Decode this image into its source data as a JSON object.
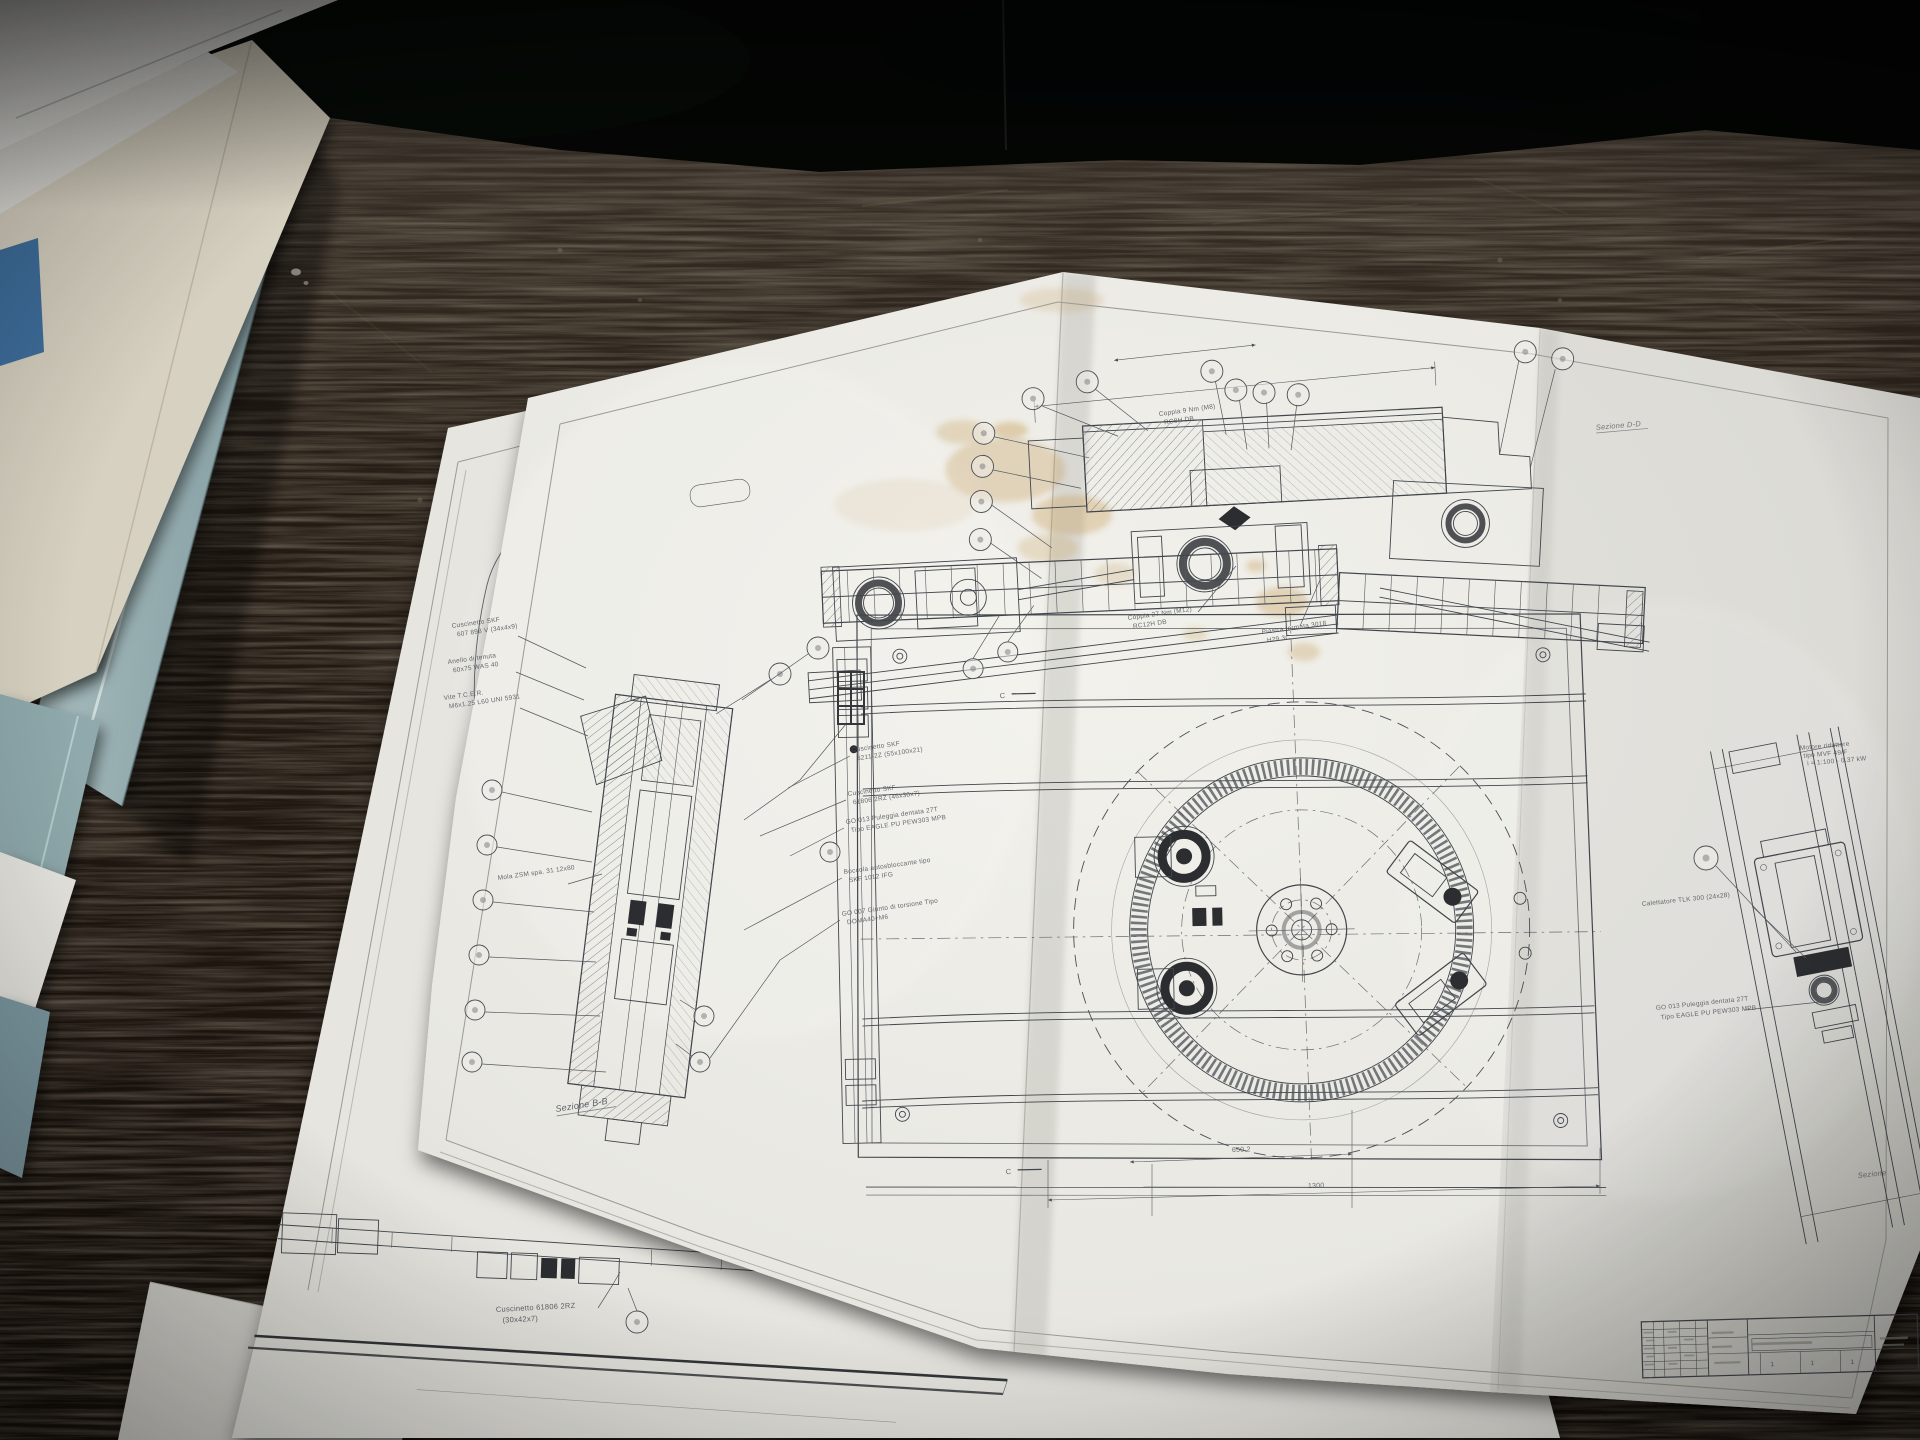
{
  "scene": {
    "description": "Photograph of folded Italian mechanical-assembly blueprints lying on a dark scratched workshop table, with folders and binders stacked at the left",
    "colors": {
      "background_top": "#050705",
      "table_wood": "#241a12",
      "paper": "#efeee8",
      "paper_under": "#e6e5df",
      "ink": "#41464c",
      "stain": "#c09040",
      "binder_teal": "#9db5b8",
      "folder_beige": "#d7d1c1",
      "folder_gray": "#a8a69a",
      "book_blue": "#3f6f9d"
    }
  },
  "main_sheet": {
    "captions": {
      "section_dd": "Sezione D-D",
      "section_bb": "Sezione B-B",
      "section_partial": "Sezione"
    },
    "top_view": {
      "labels": [
        {
          "line1": "Coppia 9 Nm (M8)",
          "line2": "RC8H DB"
        },
        {
          "line1": "Coppia 27 Nm (M12)",
          "line2": "RC12H DB"
        },
        {
          "line1": "Piastra fermata 3018",
          "line2": "H29 3C"
        }
      ]
    },
    "detail_view": {
      "labels_left": [
        {
          "line1": "Cuscinetto SKF",
          "line2": "607 898 V (34x4x9)"
        },
        {
          "line1": "Anello di tenuta",
          "line2": "60x75 WAS 40"
        },
        {
          "line1": "Vite T.C.E.R.",
          "line2": "M6x1.25 L60 UNI 5931"
        },
        {
          "line1": "Mola ZSM spa. 31 12x80",
          "line2": ""
        }
      ],
      "labels_right": [
        {
          "line1": "Cuscinetto SKF",
          "line2": "6211-2Z (55x100x21)"
        },
        {
          "line1": "Cuscinetto SKF",
          "line2": "61806 2RZ (46x30x7)"
        },
        {
          "line1": "GO 013 Puleggia dentata  27T",
          "line2": "Tipo EAGLE PU PEW303 MPB"
        },
        {
          "line1": "Boccola autosbloccante tipo",
          "line2": "SKF 1012 IFG"
        },
        {
          "line1": "GO 007 Giunto di torsione Tipo",
          "line2": "DOMA40+M6"
        }
      ]
    },
    "plan_view": {
      "dimensions": [
        "650.2",
        "1300"
      ],
      "section_marks": [
        "C",
        "C"
      ]
    },
    "side_view": {
      "note_lines": [
        "Motore riduttore",
        "tipo MVF 49/F",
        "i = 1:100 - 0.37 kW"
      ],
      "labels": [
        {
          "line1": "Calettatore TLK 300 (24x28)",
          "line2": ""
        },
        {
          "line1": "GO 013 Puleggia dentata  27T",
          "line2": "Tipo EAGLE PU PEW303 MPB"
        }
      ]
    },
    "title_block": {
      "bottom_cells": [
        "1",
        "1",
        "1"
      ]
    }
  },
  "under_sheet": {
    "labels": [
      {
        "line1": "Cuscinetto 61806 2RZ",
        "line2": "(30x42x7)"
      }
    ]
  }
}
